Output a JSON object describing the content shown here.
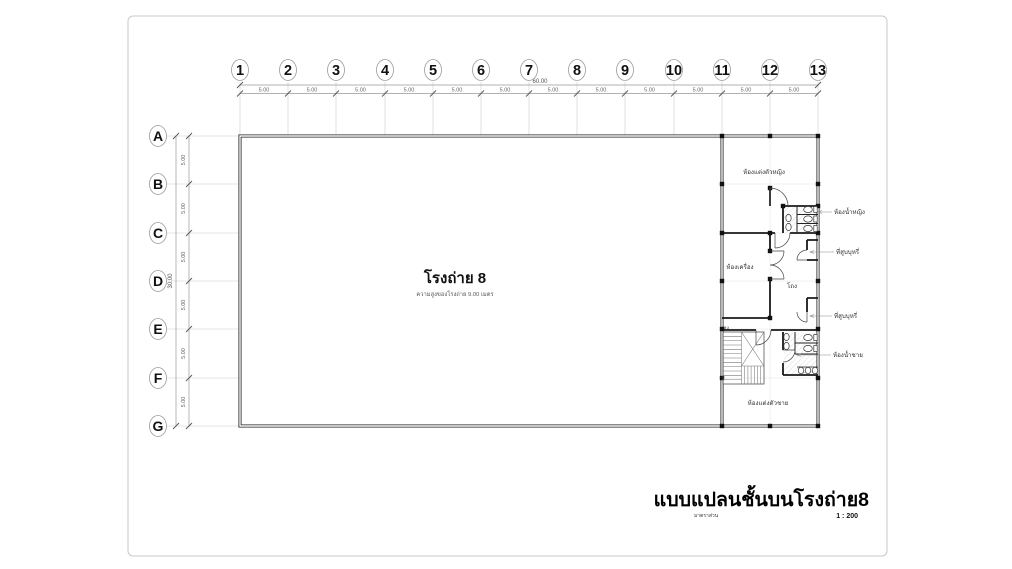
{
  "page": {
    "title": "แบบแปลนชั้นบนโรงถ่าย8",
    "scale_label": "มาตราส่วน",
    "scale_value": "1 : 200"
  },
  "grid": {
    "columns": [
      "1",
      "2",
      "3",
      "4",
      "5",
      "6",
      "7",
      "8",
      "9",
      "10",
      "11",
      "12",
      "13"
    ],
    "rows": [
      "A",
      "B",
      "C",
      "D",
      "E",
      "F",
      "G"
    ],
    "bay_label": "5.00",
    "total_width_label": "60.00",
    "total_height_label": "30.00"
  },
  "rooms": {
    "studio_name": "โรงถ่าย 8",
    "studio_note": "ความสูงของโรงถ่าย 9.00 เมตร",
    "dressing_female": "ห้องแต่งตัวหญิง",
    "toilet_female": "ห้องน้ำหญิง",
    "smoking_upper": "ที่สูบบุหรี่",
    "machine_room": "ห้องเครื่อง",
    "hall": "โถง",
    "smoking_lower": "ที่สูบบุหรี่",
    "toilet_male": "ห้องน้ำชาย",
    "dressing_male": "ห้องแต่งตัวชาย",
    "stair_down": "ลง"
  },
  "colors": {
    "wall": "#1a1a1a",
    "grid_line": "#cccccc",
    "dimension_line": "#999999",
    "dimension_text": "#555555",
    "label_text": "#333333",
    "paper_border": "#c9c9c9"
  }
}
